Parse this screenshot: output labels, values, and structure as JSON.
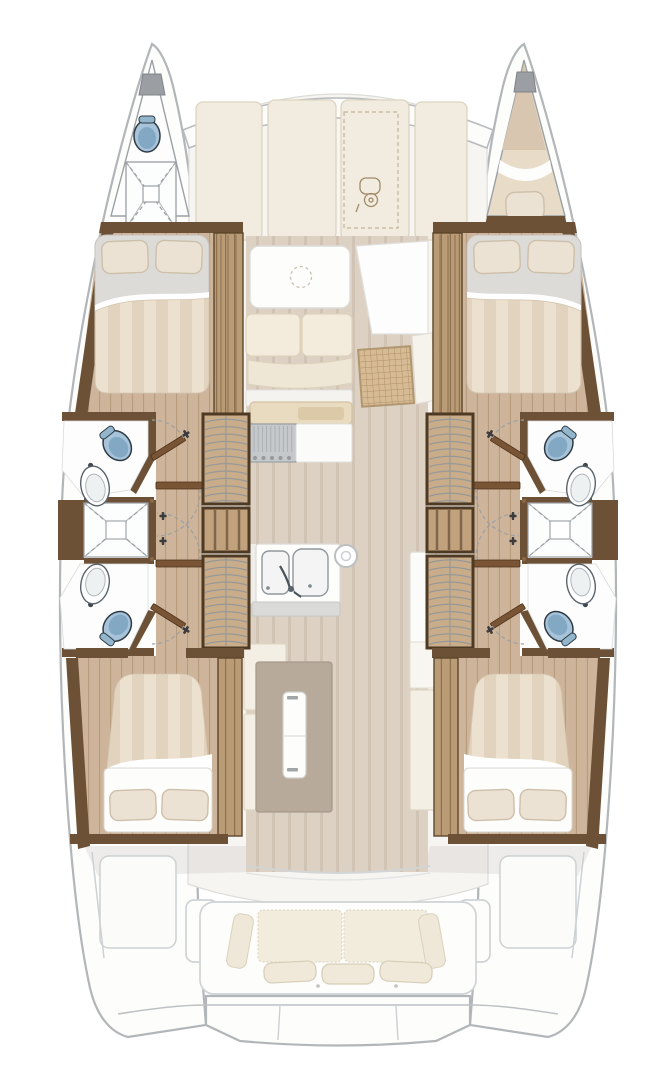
{
  "title": "Catamaran interior deck plan — 4 cabins, 4 heads layout, top-down view",
  "colors": {
    "outline": "#b2b6b9",
    "darkWood": "#6d5136",
    "midWood": "#8a6845",
    "door": "#7a5535",
    "woodFloor": "#cdb49a",
    "salonFloor": "#ddd1c4",
    "wardrobe": "#b99b76",
    "stairWood": "#c9ac89",
    "duvetA": "#ece1cf",
    "duvetB": "#e1d3bd",
    "pillow": "#ece2d3",
    "pillowEdge": "#cdbfa9",
    "cream": "#f4efe4",
    "ghostPanel": "#f1ecdf",
    "ghostPanelBorder": "#dcd4c1",
    "bathFloor": "#fdfdfd",
    "toilet": "#a6c3d9",
    "toiletDark": "#7ca3bf",
    "island": "#b7aa9a",
    "counterTan": "#e9dbc0",
    "cooktop": "#c6c9cb",
    "weave": "#d6bb94",
    "sheet": "#ffffff"
  },
  "areas": {
    "portBowHead": {
      "label": "Port bow head: toilet and shower tray"
    },
    "starboardBowBerth": {
      "label": "Starboard bow berth with pillow and deck hatch"
    },
    "portForwardCabin": {
      "label": "Port forward double cabin: bed with 2 pillows, wardrobe"
    },
    "portAftCabin": {
      "label": "Port aft double cabin: bed with 2 pillows, wardrobe"
    },
    "portHeads": {
      "label": "Port en-suite heads: 2 toilets, 2 washbasins, shared shower"
    },
    "starboardHull": {
      "label": "Starboard hull: forward and aft cabins, heads, shower, stairs"
    },
    "companionway": {
      "label": "Companionway stairs between salon and hull corridor"
    },
    "salon": {
      "label": "Salon: dinette table, sofa cushions, rattan coffee table"
    },
    "galley": {
      "label": "Galley: cooktop, double sink, island unit, refrigerator"
    },
    "foredeck": {
      "label": "Foredeck sun pads with tender locker and outboard engine"
    },
    "cockpit": {
      "label": "Aft cockpit bench with cushions and swim platform"
    },
    "bridgeDeck": {
      "label": "Bridge deck coachroof"
    }
  }
}
